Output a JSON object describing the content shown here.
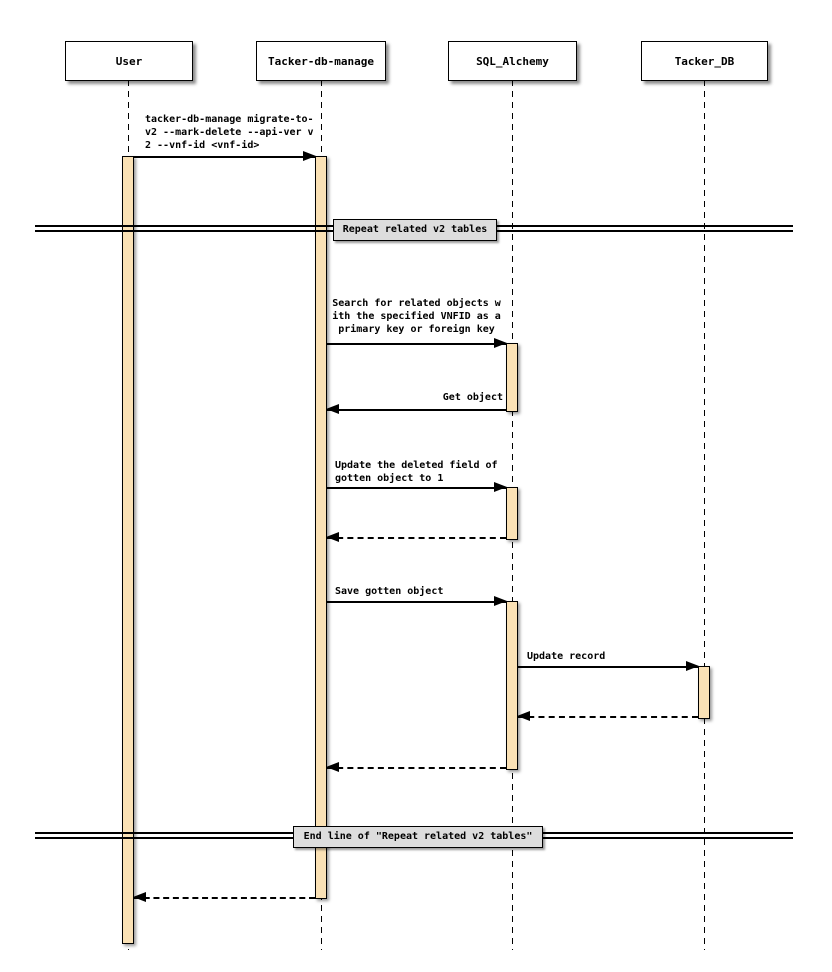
{
  "diagram_type": "uml-sequence-diagram",
  "participants": [
    {
      "name": "User"
    },
    {
      "name": "Tacker-db-manage"
    },
    {
      "name": "SQL_Alchemy"
    },
    {
      "name": "Tacker_DB"
    }
  ],
  "dividers": [
    {
      "label": "Repeat related v2 tables"
    },
    {
      "label": "End line of \"Repeat related v2 tables\""
    }
  ],
  "messages": [
    {
      "from": "User",
      "to": "Tacker-db-manage",
      "style": "solid",
      "label": "tacker-db-manage migrate-to-\nv2 --mark-delete --api-ver v\n2 --vnf-id <vnf-id>"
    },
    {
      "from": "Tacker-db-manage",
      "to": "SQL_Alchemy",
      "style": "solid",
      "label": "Search for related objects w\nith the specified VNFID as a\nprimary key or foreign key"
    },
    {
      "from": "SQL_Alchemy",
      "to": "Tacker-db-manage",
      "style": "solid",
      "label": "Get object"
    },
    {
      "from": "Tacker-db-manage",
      "to": "SQL_Alchemy",
      "style": "solid",
      "label": "Update the deleted field of\ngotten object to 1"
    },
    {
      "from": "SQL_Alchemy",
      "to": "Tacker-db-manage",
      "style": "dashed-return",
      "label": ""
    },
    {
      "from": "Tacker-db-manage",
      "to": "SQL_Alchemy",
      "style": "solid",
      "label": "Save gotten object"
    },
    {
      "from": "SQL_Alchemy",
      "to": "Tacker_DB",
      "style": "solid",
      "label": "Update record"
    },
    {
      "from": "Tacker_DB",
      "to": "SQL_Alchemy",
      "style": "dashed-return",
      "label": ""
    },
    {
      "from": "SQL_Alchemy",
      "to": "Tacker-db-manage",
      "style": "dashed-return",
      "label": ""
    },
    {
      "from": "Tacker-db-manage",
      "to": "User",
      "style": "dashed-return",
      "label": ""
    }
  ],
  "colors": {
    "activation_fill": "#FAE1B5",
    "divider_fill": "#DDDDDD",
    "line": "#000000",
    "background": "#FFFFFF"
  }
}
